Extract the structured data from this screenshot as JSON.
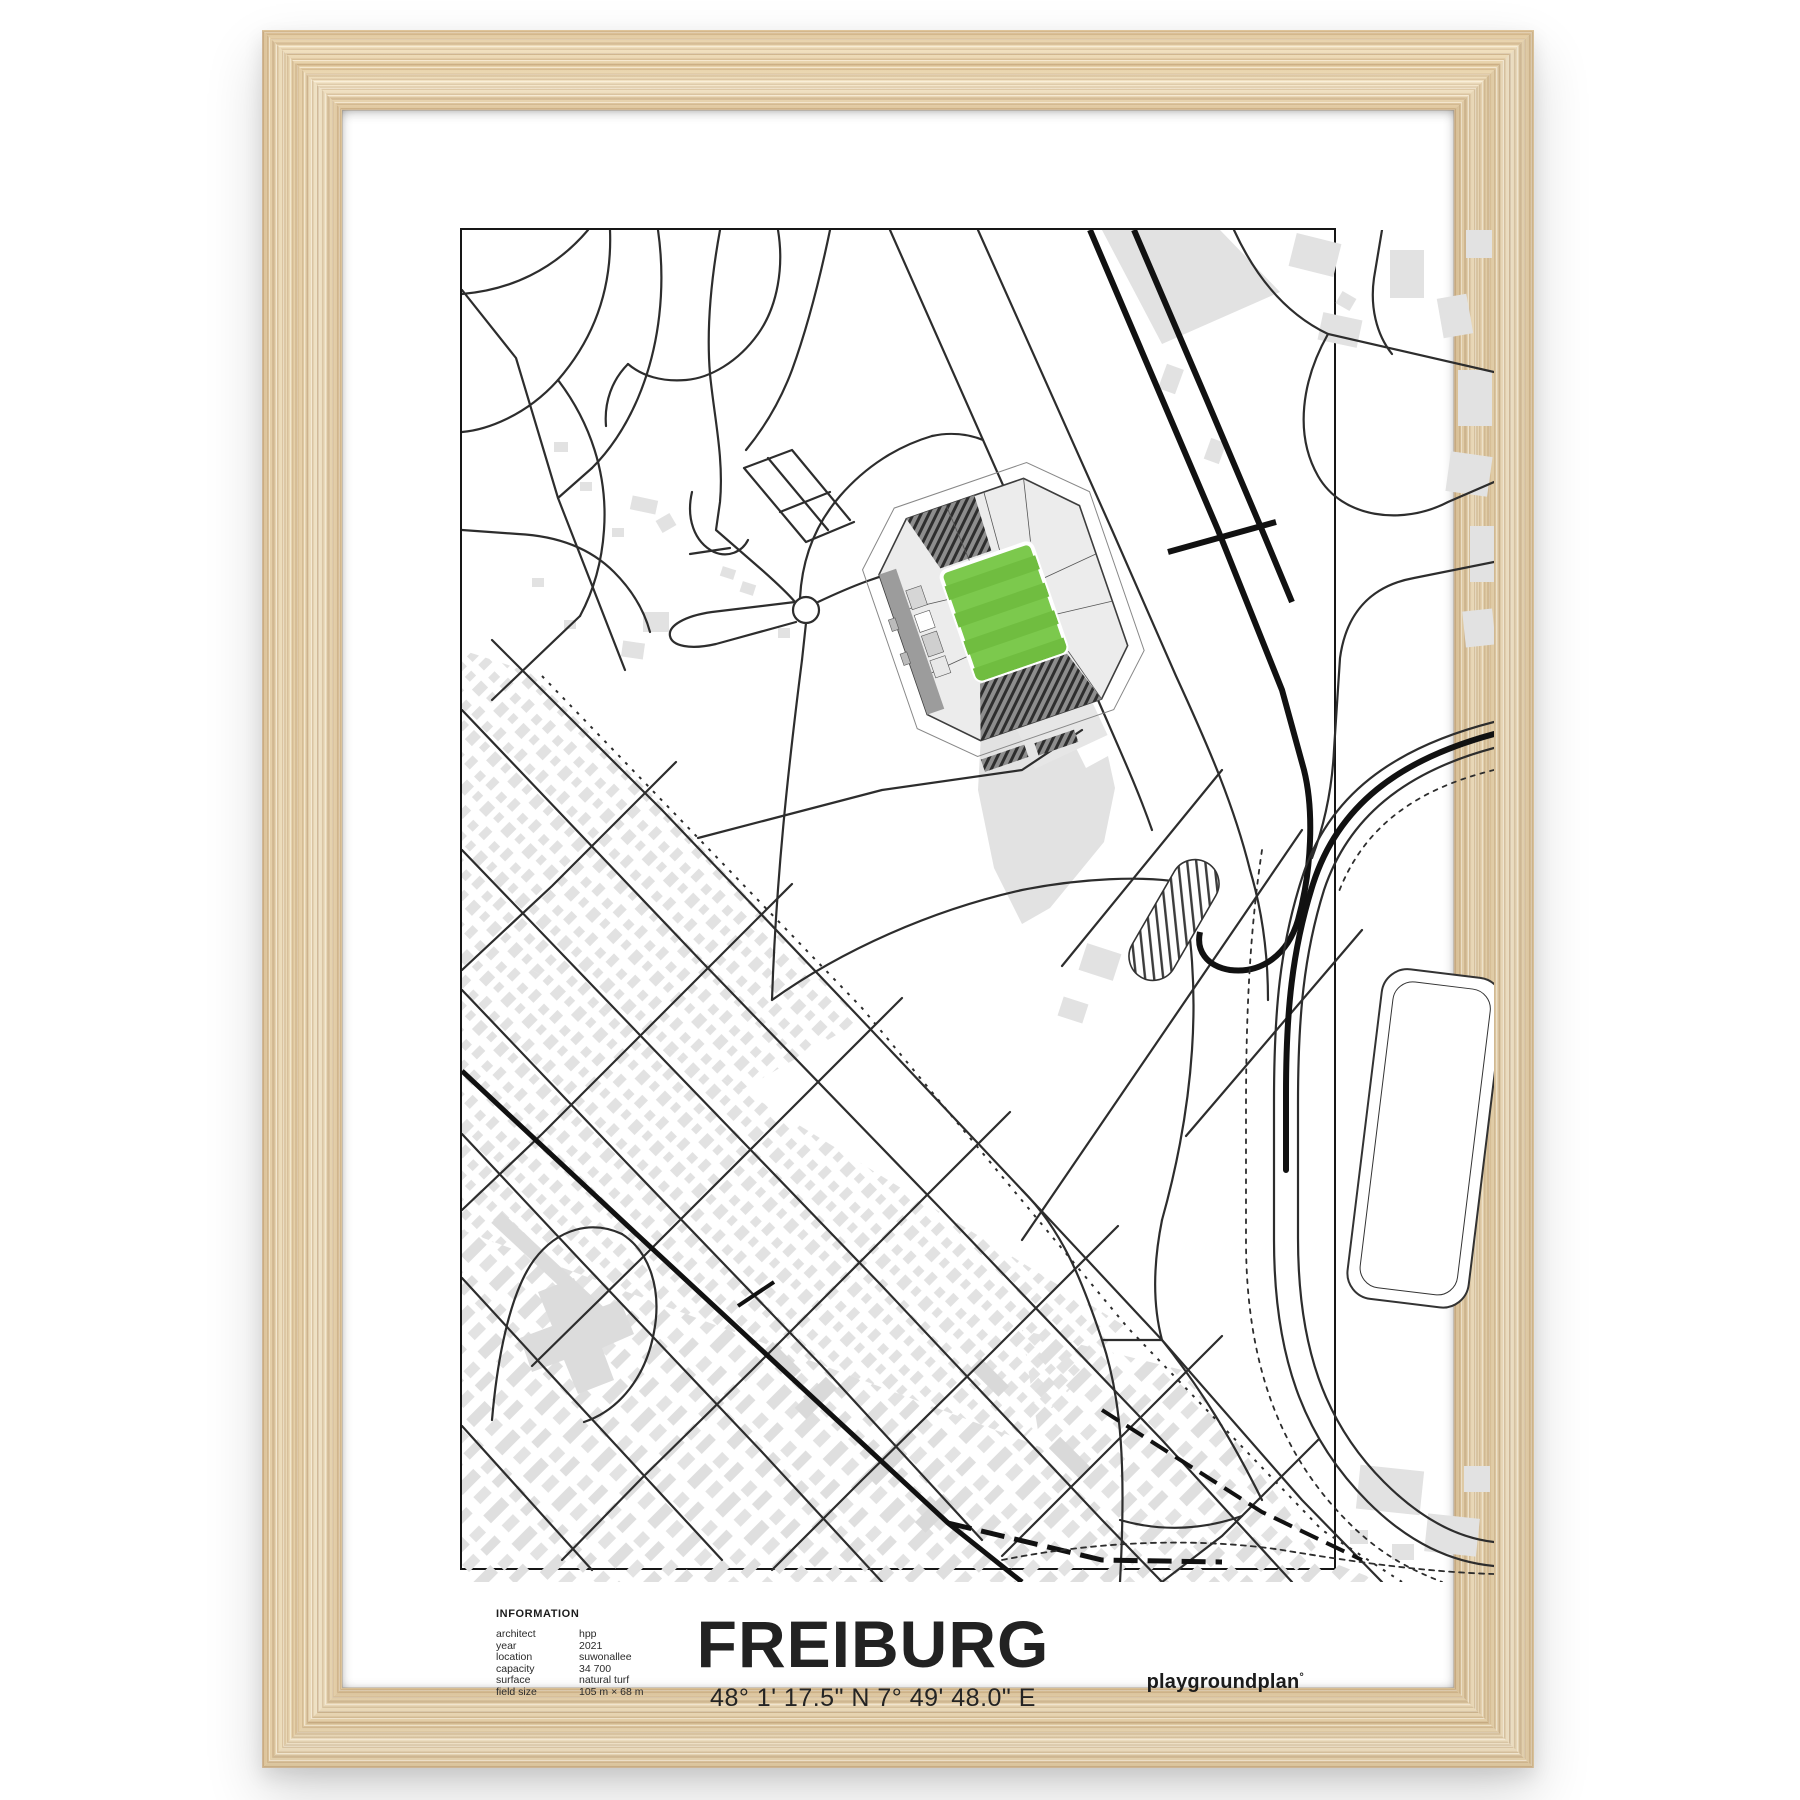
{
  "poster": {
    "title": "FREIBURG",
    "coordinates": "48° 1' 17.5\" N  7° 49' 48.0\" E",
    "brand": {
      "name": "playgroundplan",
      "mark": "°"
    },
    "info": {
      "heading": "INFORMATION",
      "rows": [
        {
          "label": "architect",
          "value": "hpp"
        },
        {
          "label": "year",
          "value": "2021"
        },
        {
          "label": "location",
          "value": "suwonallee"
        },
        {
          "label": "capacity",
          "value": "34 700"
        },
        {
          "label": "surface",
          "value": "natural turf"
        },
        {
          "label": "field size",
          "value": "105 m × 68 m"
        }
      ]
    },
    "map_features": [
      "park-paths",
      "roundabout",
      "stadium",
      "airfield-runway",
      "railway",
      "residential-grid",
      "riverside-road",
      "athletics-oval",
      "sports-field"
    ],
    "colors": {
      "pitch_green": "#7cc94d",
      "pitch_stripe": "#70bd40",
      "building_gray": "#e2e2e2",
      "map_line": "#2d2d2d",
      "rail_black": "#111111",
      "stand_gray": "#8d8d8d",
      "frame_wood": "#eddcba"
    }
  }
}
